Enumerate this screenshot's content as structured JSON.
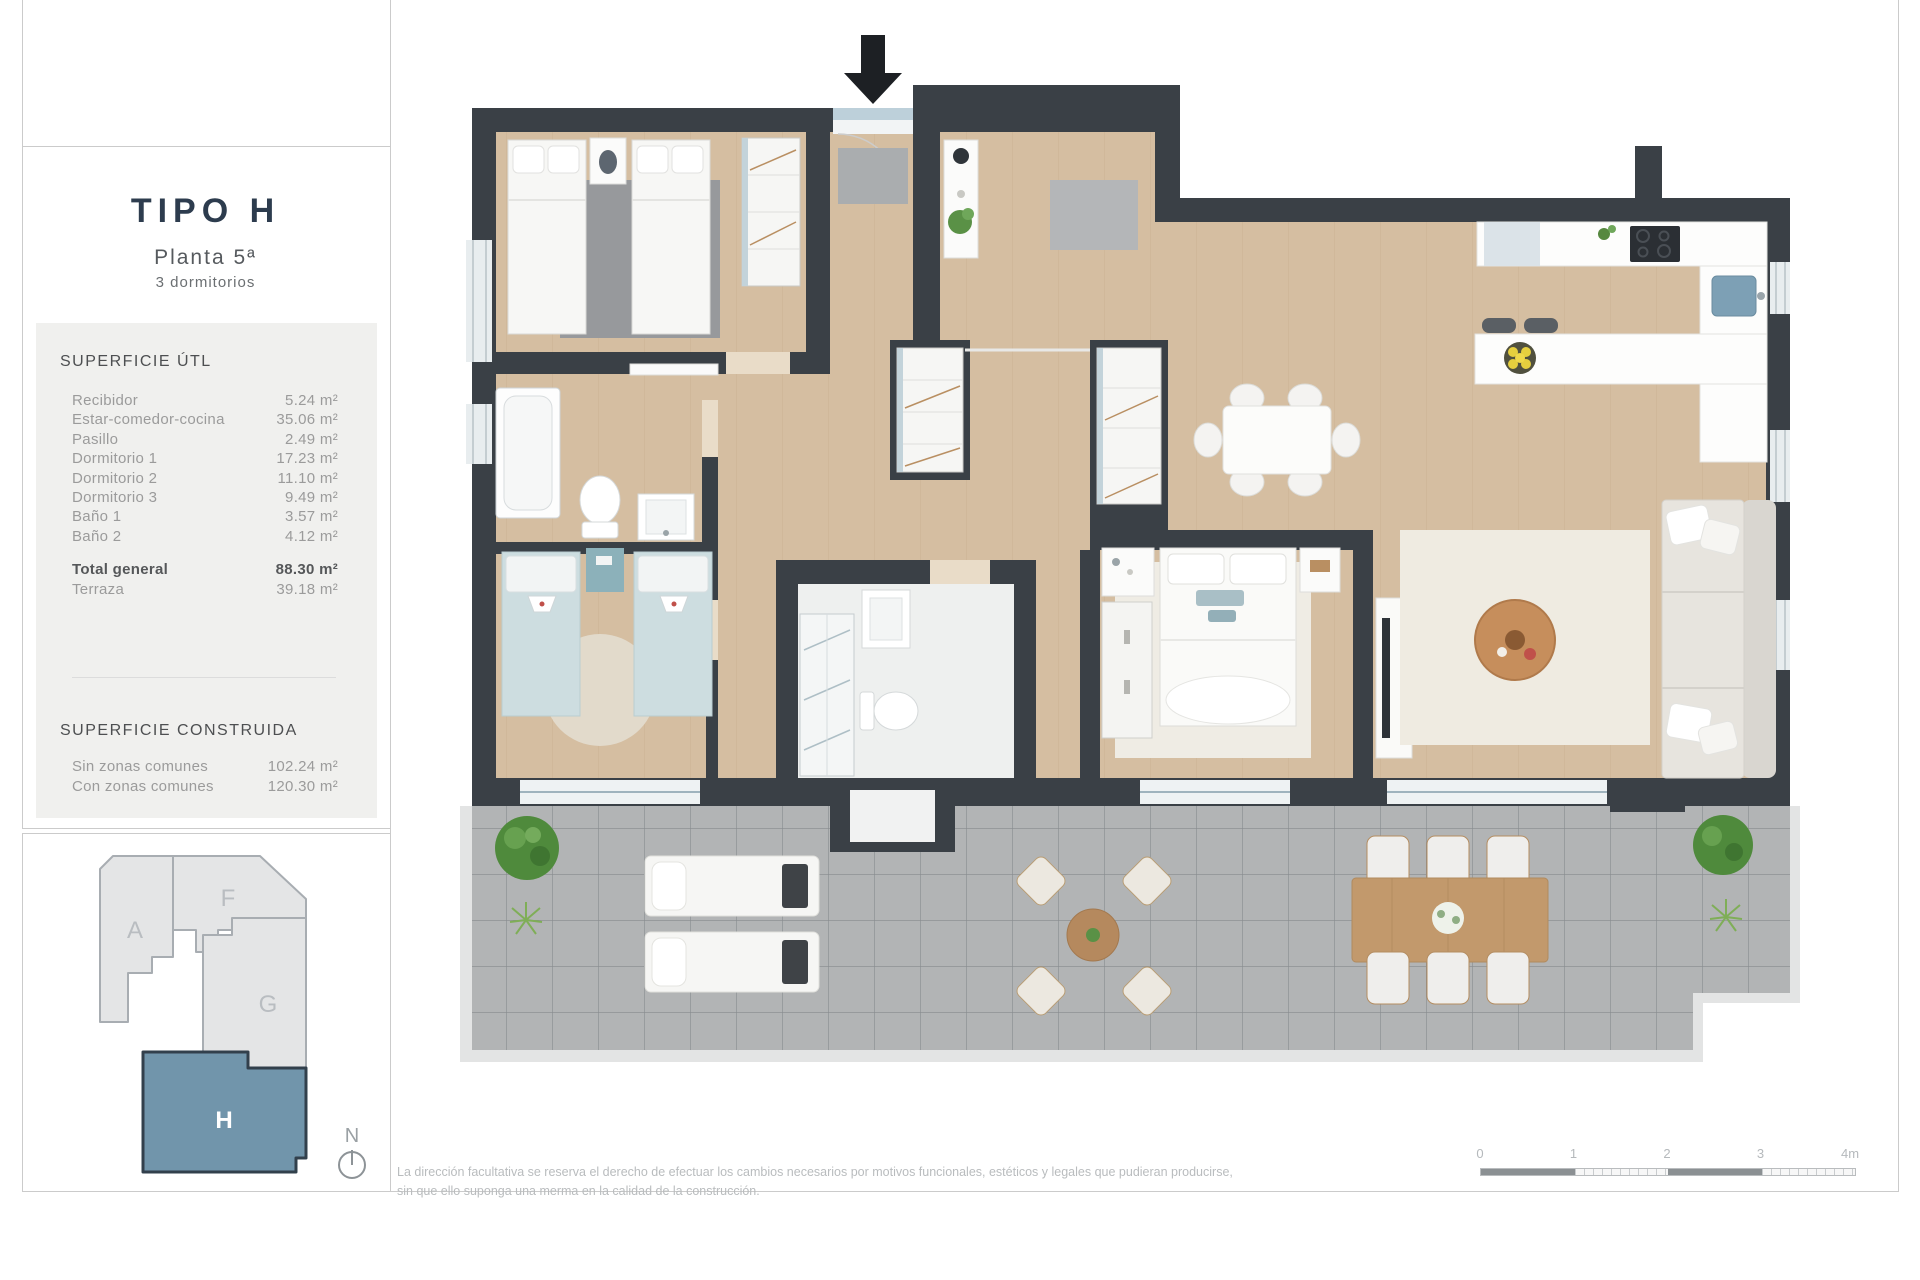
{
  "sidebar": {
    "title": "TIPO H",
    "floor": "Planta 5ª",
    "bedrooms": "3 dormitorios",
    "superficie_util": {
      "heading": "SUPERFICIE ÚTL",
      "rows": [
        {
          "label": "Recibidor",
          "value": "5.24 m²"
        },
        {
          "label": "Estar-comedor-cocina",
          "value": "35.06 m²"
        },
        {
          "label": "Pasillo",
          "value": "2.49 m²"
        },
        {
          "label": "Dormitorio 1",
          "value": "17.23 m²"
        },
        {
          "label": "Dormitorio 2",
          "value": "11.10 m²"
        },
        {
          "label": "Dormitorio 3",
          "value": "9.49 m²"
        },
        {
          "label": "Baño 1",
          "value": "3.57 m²"
        },
        {
          "label": "Baño 2",
          "value": "4.12 m²"
        }
      ],
      "total_label": "Total general",
      "total_value": "88.30 m²",
      "terrace_label": "Terraza",
      "terrace_value": "39.18 m²"
    },
    "superficie_construida": {
      "heading": "SUPERFICIE CONSTRUIDA",
      "rows": [
        {
          "label": "Sin zonas comunes",
          "value": "102.24 m²"
        },
        {
          "label": "Con zonas comunes",
          "value": "120.30 m²"
        }
      ]
    }
  },
  "keyplan": {
    "block_a": "A",
    "block_f": "F",
    "block_g": "G",
    "block_h": "H",
    "highlight_color": "#7195ab",
    "north_label": "N"
  },
  "footer": {
    "disclaimer_line1": "La dirección facultativa se reserva el derecho de efectuar los cambios necesarios por motivos funcionales, estéticos y legales que pudieran producirse,",
    "disclaimer_line2": "sin que ello suponga una merma en la calidad de la construcción.",
    "scalebar": {
      "t0": "0",
      "t1": "1",
      "t2": "2",
      "t3": "3",
      "t4": "4m"
    }
  },
  "floorplan": {
    "entry_arrow_icon": "down-arrow",
    "north_icon": "compass-north",
    "wall_color": "#3a4046",
    "wood_color": "#d5bea1",
    "terrace_tile_color": "#b2b4b5",
    "accent_teal": "#8cb1ba",
    "sink_blue": "#7da0b5"
  }
}
